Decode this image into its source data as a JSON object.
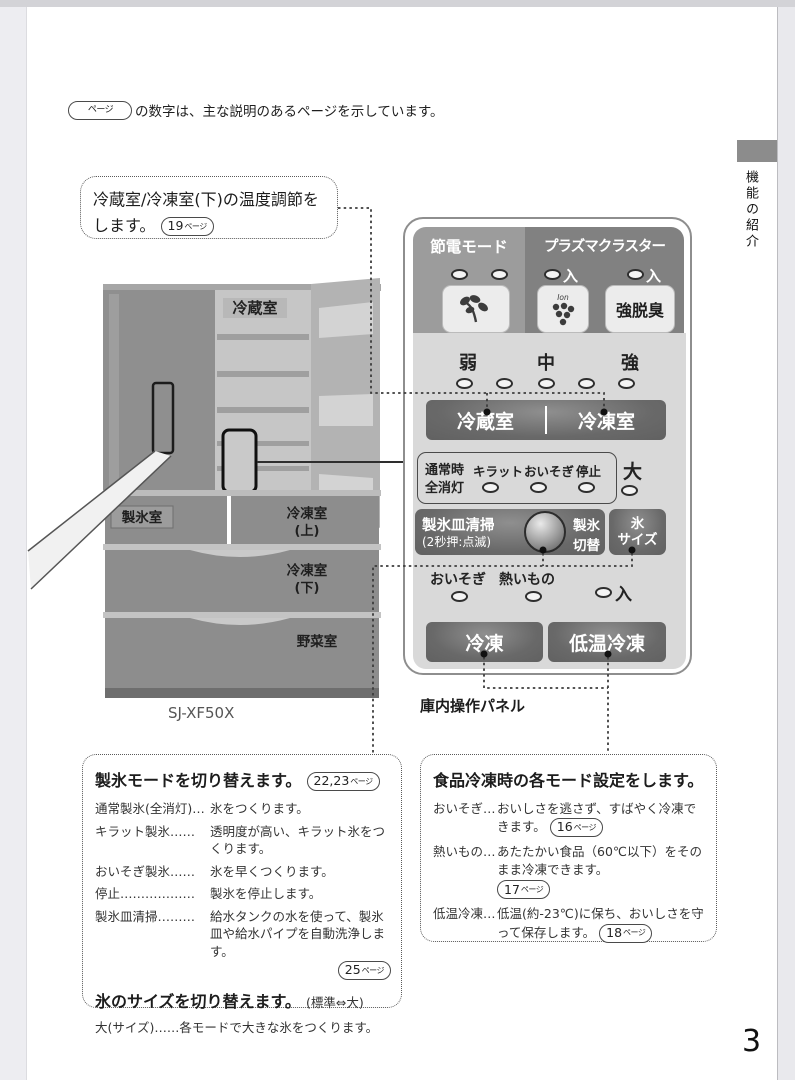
{
  "page": {
    "number": "3",
    "tab": "機能の紹介",
    "note_pill": "ページ",
    "note_text": "の数字は、主な説明のあるページを示しています。"
  },
  "callout": {
    "line1": "冷蔵室/冷凍室(下)の温度調節を",
    "line2": "します。",
    "pill": {
      "num": "19",
      "unit": "ページ"
    }
  },
  "fridge": {
    "model": "SJ-XF50X",
    "label_fridge": "冷蔵室",
    "label_ice_room": "製氷室",
    "label_freezer_upper1": "冷凍室",
    "label_freezer_upper2": "(上)",
    "label_freezer_lower1": "冷凍室",
    "label_freezer_lower2": "(下)",
    "label_veg": "野菜室"
  },
  "panel": {
    "caption": "庫内操作パネル",
    "eco_label": "節電モード",
    "plasma_label": "プラズマクラスター",
    "plasma_on1": "入",
    "plasma_on2": "入",
    "ion_text": "Ion",
    "deodorize": "強脱臭",
    "level_weak": "弱",
    "level_mid": "中",
    "level_strong": "強",
    "btn_fridge": "冷蔵室",
    "btn_freezer": "冷凍室",
    "normal1": "通常時",
    "normal2": "全消灯",
    "lbl_kiratto": "キラット",
    "lbl_oisogi": "おいそぎ",
    "lbl_stop": "停止",
    "lbl_large": "大",
    "ice_clean1": "製氷皿清掃",
    "ice_clean2": "(2秒押:点滅)",
    "ice_switch1": "製氷",
    "ice_switch2": "切替",
    "ice_size1": "氷",
    "ice_size2": "サイズ",
    "lbl_oisogi2": "おいそぎ",
    "lbl_hot": "熱いもの",
    "lbl_on": "入",
    "btn_freeze": "冷凍",
    "btn_lowtemp": "低温冷凍"
  },
  "box_ice": {
    "title": "製氷モードを切り替えます。",
    "pill": {
      "num": "22,23",
      "unit": "ページ"
    },
    "rows": [
      {
        "term": "通常製氷(全消灯)…",
        "desc": "氷をつくります。"
      },
      {
        "term": "キラット製氷……",
        "desc": "透明度が高い、キラット氷をつくります。"
      },
      {
        "term": "おいそぎ製氷……",
        "desc": "氷を早くつくります。"
      },
      {
        "term": "停止………………",
        "desc": "製氷を停止します。"
      },
      {
        "term": "製氷皿清掃………",
        "desc": "給水タンクの水を使って、製氷皿や給水パイプを自動洗浄します。",
        "pill": {
          "num": "25",
          "unit": "ページ"
        }
      }
    ],
    "subtitle": "氷のサイズを切り替えます。",
    "subtitle_note": "(標準⇔大)",
    "size_term": "大(サイズ)",
    "size_desc": "……各モードで大きな氷をつくります。"
  },
  "box_freeze": {
    "title": "食品冷凍時の各モード設定をします。",
    "rows": [
      {
        "term": "おいそぎ…",
        "desc": "おいしさを逃さず、すばやく冷凍できます。",
        "pill": {
          "num": "16",
          "unit": "ページ"
        }
      },
      {
        "term": "熱いもの…",
        "desc": "あたたかい食品（60℃以下）をそのまま冷凍できます。",
        "pill": {
          "num": "17",
          "unit": "ページ"
        }
      },
      {
        "term": "低温冷凍…",
        "desc": "低温(約-23℃)に保ち、おいしさを守って保存します。",
        "pill": {
          "num": "18",
          "unit": "ページ"
        }
      }
    ]
  },
  "colors": {
    "section_eco": "#9c9c9c",
    "section_plasma": "#818181",
    "panel_body": "#d9d9d9",
    "dark_button": "#686868"
  }
}
